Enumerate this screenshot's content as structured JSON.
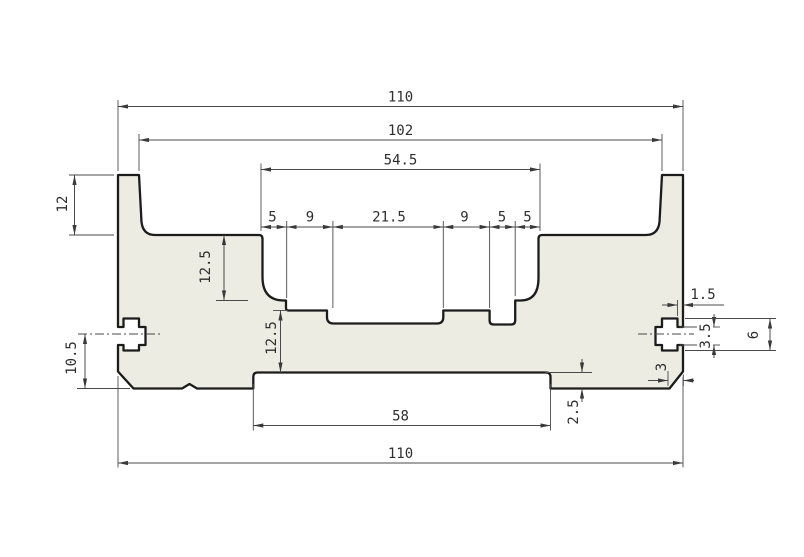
{
  "drawing": {
    "type": "technical-section-profile",
    "colors": {
      "background": "#ffffff",
      "part_fill": "#ecece2",
      "outline": "#1c1c1c",
      "dim": "#4a4a4a",
      "text": "#2e2e2e"
    },
    "dimensions": {
      "top": {
        "overall": "110",
        "between_tabs": "102",
        "pocket_width": "54.5"
      },
      "pocket_segments": {
        "left_wall": "5",
        "left_floor": "9",
        "center": "21.5",
        "right_floor": "9",
        "channel": "5",
        "right_wall": "5"
      },
      "left": {
        "tab_height": "12",
        "pocket_depth": "12.5",
        "lower_step_depth": "12.5",
        "slot_center_to_bottom": "10.5"
      },
      "bottom": {
        "recess_width": "58",
        "overall": "110",
        "recess_depth": "2.5",
        "chamfer": "3"
      },
      "right_slot": {
        "lip_depth": "1.5",
        "mouth_height": "3.5",
        "height": "6"
      }
    }
  }
}
